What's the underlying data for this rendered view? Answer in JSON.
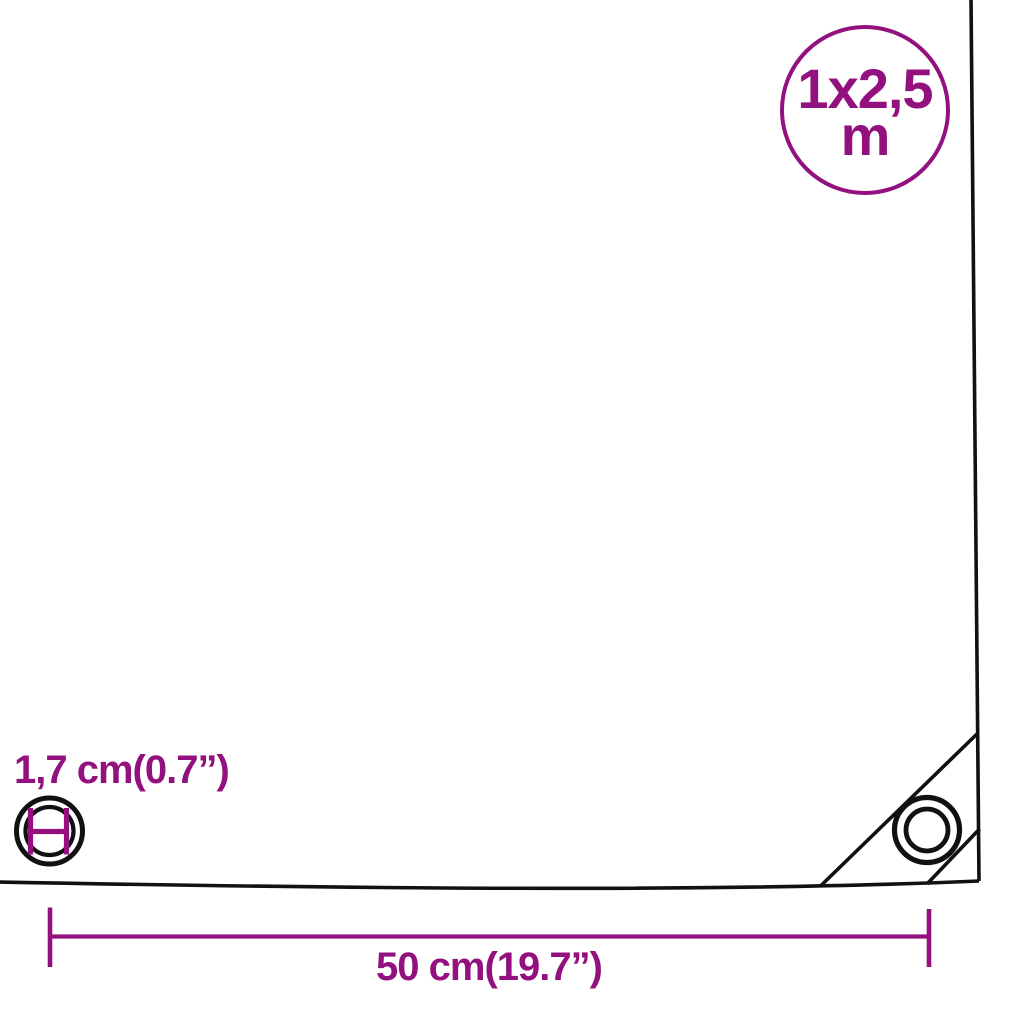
{
  "page": {
    "description": "Tarpaulin product dimension diagram"
  },
  "colors": {
    "accent": "#93117E",
    "line": "#111111",
    "bg": "#ffffff"
  },
  "size_badge": {
    "line1": "1x2,5",
    "line2": "m"
  },
  "measurements": {
    "eyelet_diameter_label": "1,7 cm(0.7”)",
    "grommet_spacing_label": "50 cm(19.7”)"
  },
  "icons": {
    "tarp_outline": "tarp-sheet-outline",
    "eyelet": "eyelet-diameter-icon",
    "corner_grommet": "corner-grommet-icon",
    "dimension": "dimension-arrow-line"
  }
}
